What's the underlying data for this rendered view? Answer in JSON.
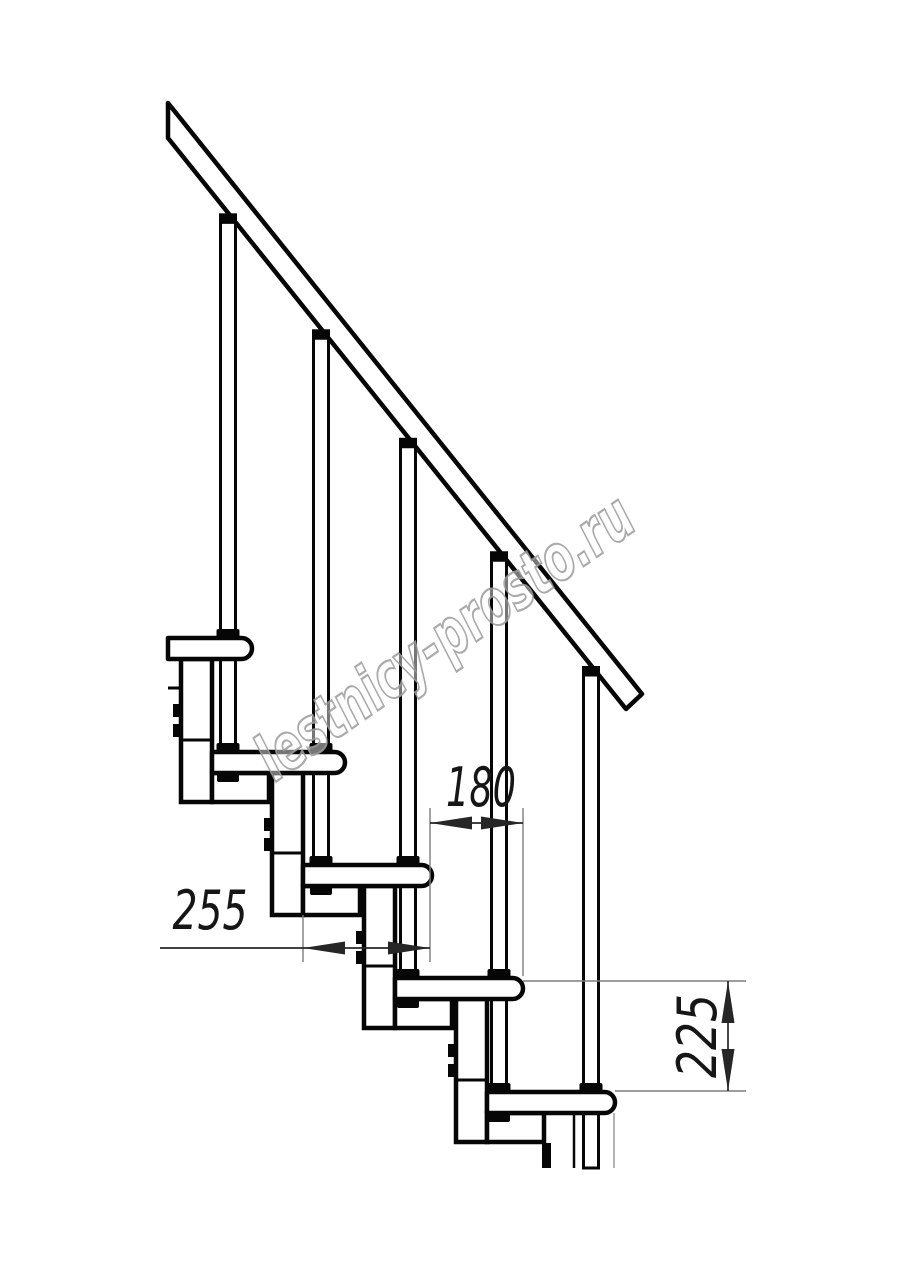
{
  "page": {
    "description": "Technical side-view drawing of a modular staircase: five treads on modular stringer boxes, baluster rods, inclined handrail, three dimension callouts and a diagonal watermark"
  },
  "labels": {
    "d180": "180",
    "d255": "255",
    "d225": "225"
  },
  "watermark": {
    "text": "lestnicy-prosto.ru",
    "x": 457,
    "y": 655,
    "rotate": -35,
    "len": 445
  },
  "geometry": {
    "canvas": {
      "w": 914,
      "h": 1280
    },
    "style": {
      "line": "#060606",
      "thick": 4.5,
      "medium": 3,
      "dim": "#262626",
      "ext": "#7d7d7d"
    },
    "dim_style": {
      "arrow_len": 42,
      "arrow_half": 6.5,
      "line_w": 1.7,
      "ext_w": 1.4
    },
    "handrail": {
      "poly": [
        [
          168,
          103
        ],
        [
          642,
          694
        ],
        [
          626,
          709
        ],
        [
          168,
          138
        ]
      ],
      "x0": 168,
      "bottom_y0": 138,
      "slope": 1.247
    },
    "treads": [
      {
        "top": 638,
        "back": 168,
        "nose": 252
      },
      {
        "top": 752,
        "back": 212,
        "nose": 345
      },
      {
        "top": 865,
        "back": 303,
        "nose": 432
      },
      {
        "top": 978,
        "back": 395,
        "nose": 523
      },
      {
        "top": 1092,
        "back": 487,
        "nose": 615
      }
    ],
    "tread_h": 21,
    "rod": {
      "nose_offset": 24,
      "w": 15,
      "cap_w": 18,
      "cap_h": 9,
      "foot_w": 23,
      "foot_h": 9,
      "nut_w": 22,
      "nut_h": 9
    },
    "column": {
      "w": 31,
      "flange_w": 57,
      "drop": 50,
      "joint_up": 12,
      "tab_dx": 39,
      "tab_w": 9,
      "tab_h": 13,
      "tab_y1": 66,
      "tab_y2": 86
    },
    "stub": {
      "x1": 168,
      "x2": 183,
      "y": 688
    },
    "cut_y": 1168,
    "below_last": {
      "bar_x": 542,
      "bar_w": 9,
      "bar_y": 1143,
      "thin_x": 574,
      "gray_x": 614
    },
    "dims": [
      {
        "id": "t180",
        "label_key": "d180",
        "ext": [
          [
            430,
            808,
            430,
            962
          ],
          [
            523,
            808,
            523,
            976
          ]
        ],
        "line": [
          430,
          823,
          523,
          823
        ],
        "arrows": [
          [
            430,
            823,
            "l"
          ],
          [
            523,
            823,
            "r"
          ]
        ],
        "label": {
          "x": 481,
          "y": 806,
          "rotate": 0,
          "len": 70
        }
      },
      {
        "id": "t255",
        "label_key": "d255",
        "ext": [
          [
            303,
            915,
            303,
            962
          ]
        ],
        "line": [
          160,
          948,
          430,
          948
        ],
        "arrows": [
          [
            303,
            948,
            "l"
          ],
          [
            430,
            948,
            "r"
          ]
        ],
        "label": {
          "x": 210,
          "y": 929,
          "rotate": 0,
          "len": 75
        }
      },
      {
        "id": "t225",
        "label_key": "d225",
        "ext": [
          [
            523,
            981,
            746,
            981
          ],
          [
            615,
            1091,
            746,
            1091
          ]
        ],
        "line": [
          728,
          981,
          728,
          1091
        ],
        "arrows": [
          [
            728,
            981,
            "u"
          ],
          [
            728,
            1091,
            "d"
          ]
        ],
        "label": {
          "x": 716,
          "y": 1036,
          "rotate": -90,
          "len": 84
        }
      }
    ]
  }
}
